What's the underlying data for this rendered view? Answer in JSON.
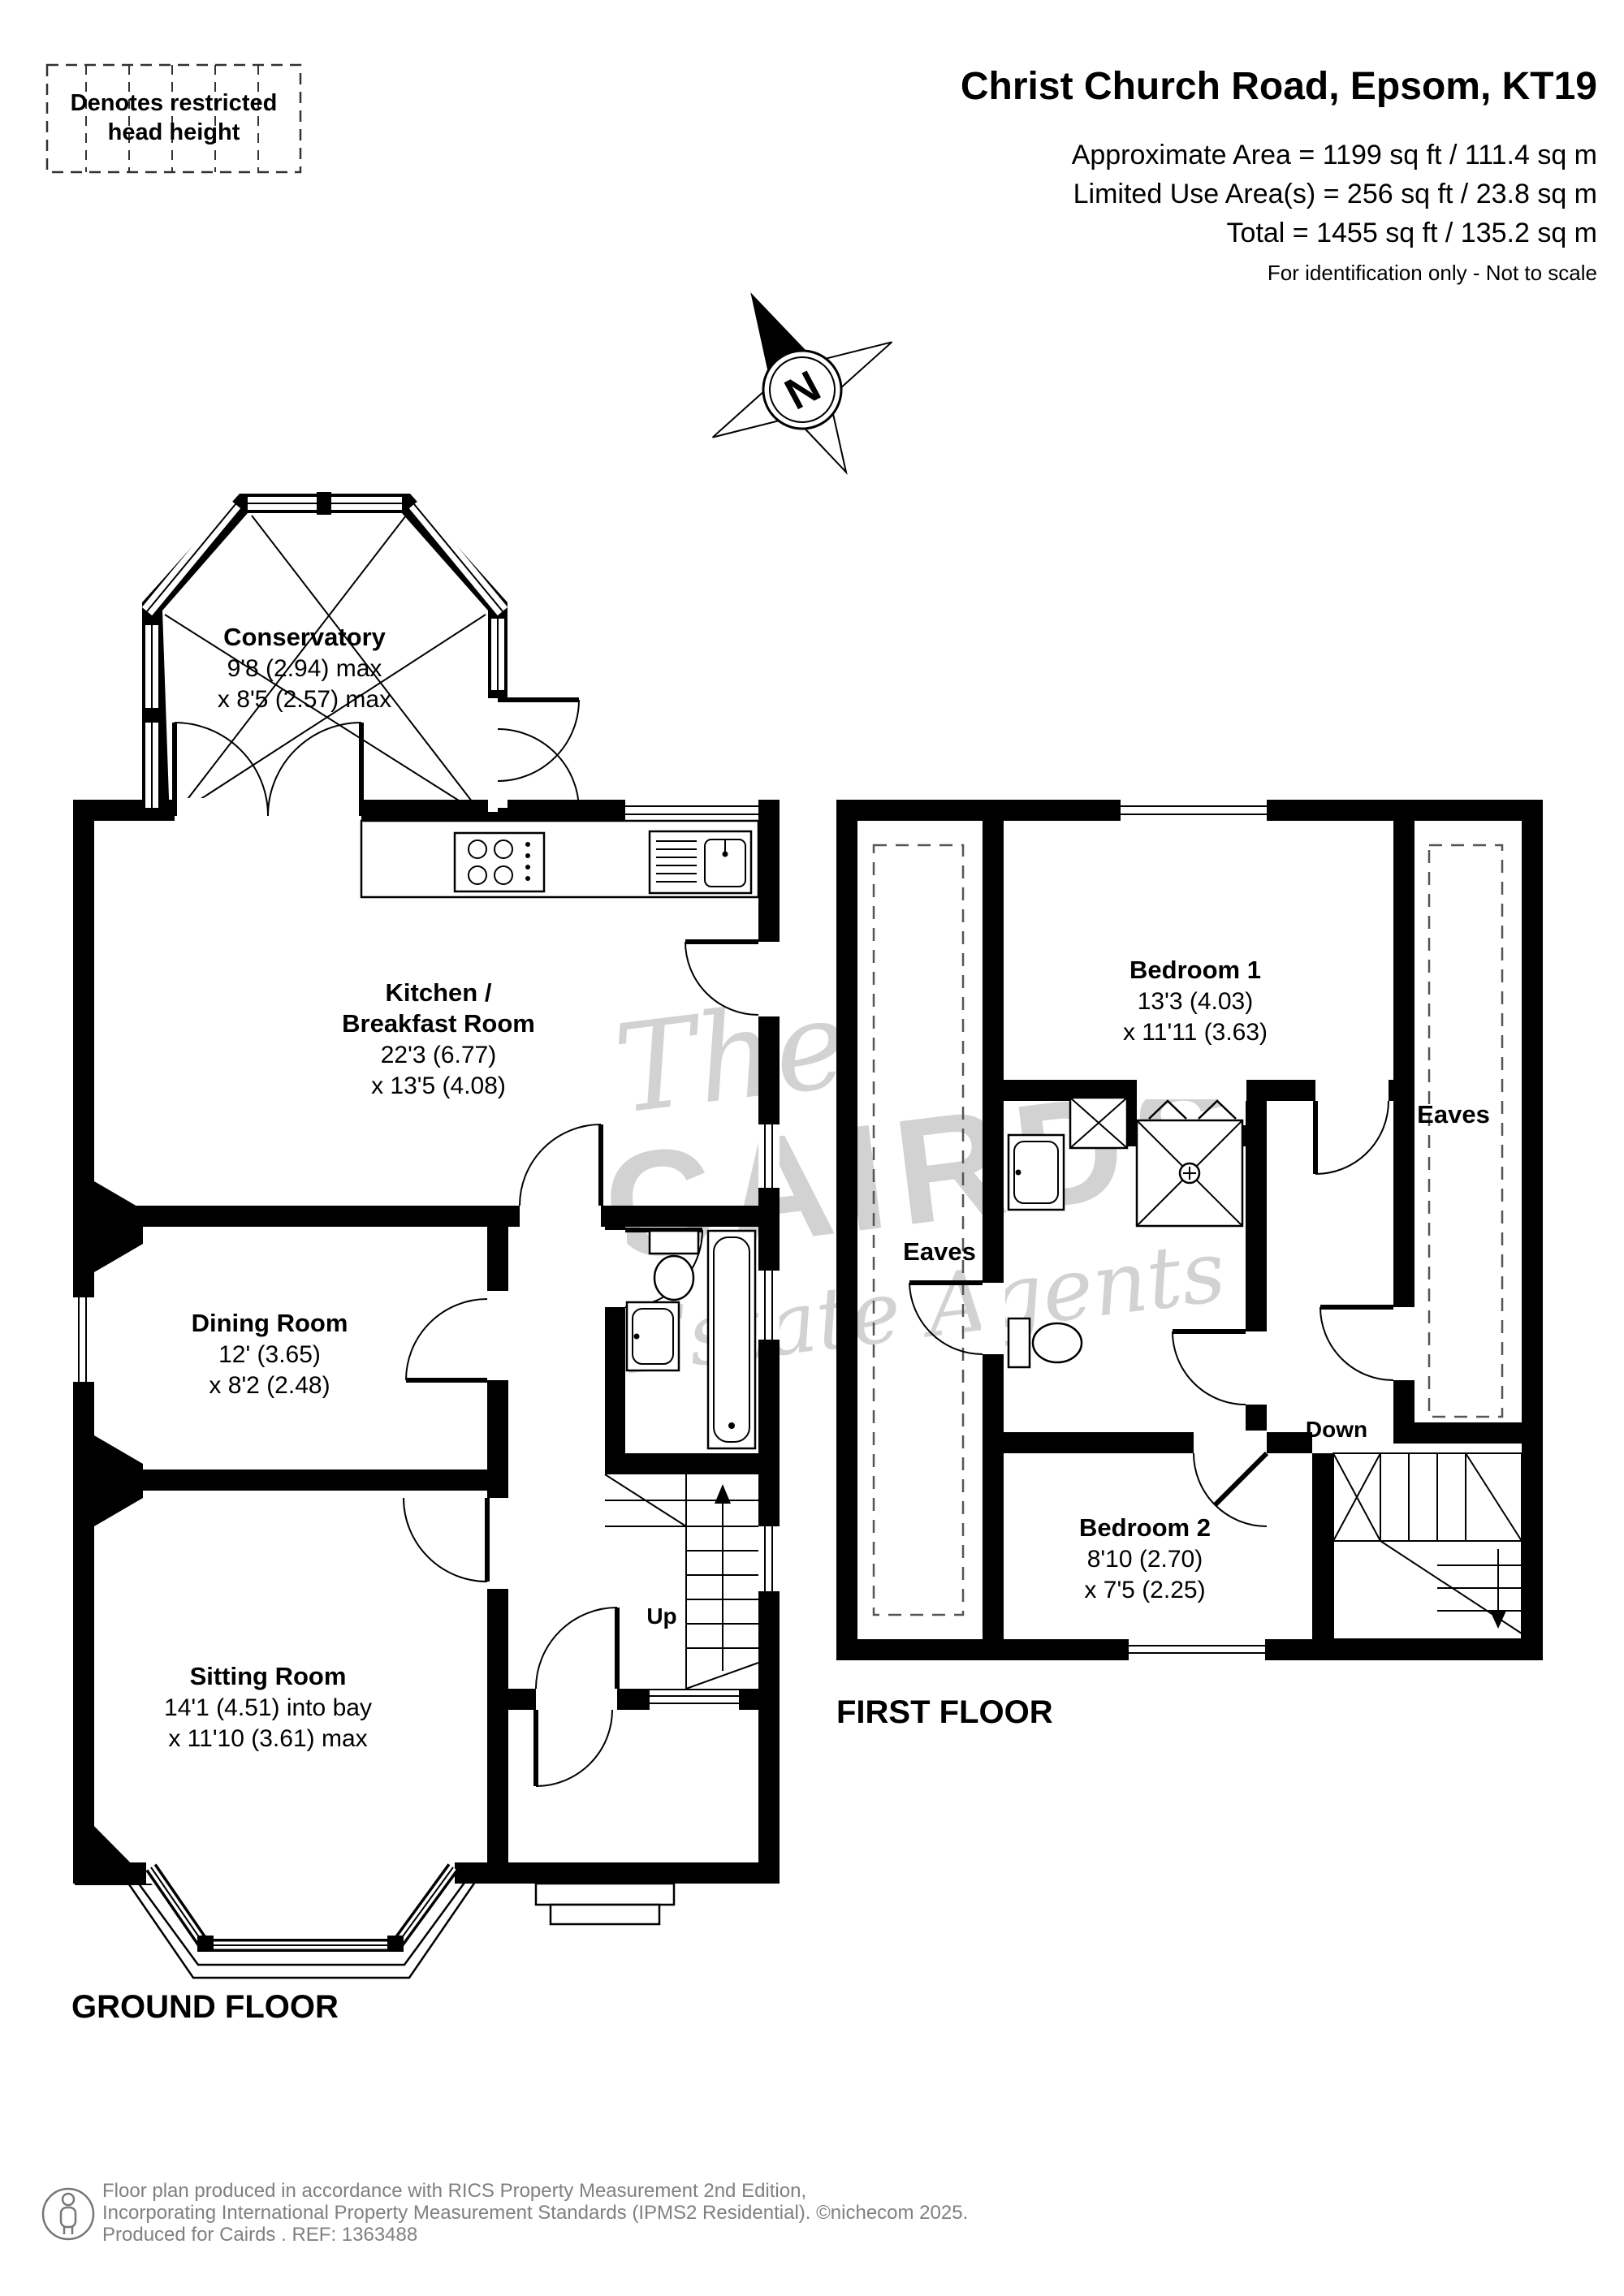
{
  "header": {
    "legend": {
      "line1": "Denotes restricted",
      "line2": "head height"
    },
    "title": "Christ Church Road, Epsom, KT19",
    "area_line1": "Approximate Area = 1199 sq ft / 111.4 sq m",
    "area_line2": "Limited Use Area(s) = 256 sq ft / 23.8 sq m",
    "area_line3": "Total = 1455 sq ft / 135.2 sq m",
    "disclaimer": "For identification only - Not to scale"
  },
  "compass": {
    "label": "N"
  },
  "ground_floor": {
    "floor_label": "GROUND FLOOR",
    "stairs_label": "Up",
    "rooms": {
      "conservatory": {
        "name": "Conservatory",
        "dim1": "9'8 (2.94) max",
        "dim2": "x 8'5 (2.57) max"
      },
      "kitchen": {
        "name1": "Kitchen /",
        "name2": "Breakfast Room",
        "dim1": "22'3 (6.77)",
        "dim2": "x 13'5 (4.08)"
      },
      "dining": {
        "name": "Dining Room",
        "dim1": "12' (3.65)",
        "dim2": "x 8'2 (2.48)"
      },
      "sitting": {
        "name": "Sitting Room",
        "dim1": "14'1 (4.51) into bay",
        "dim2": "x 11'10 (3.61) max"
      }
    }
  },
  "first_floor": {
    "floor_label": "FIRST FLOOR",
    "stairs_label": "Down",
    "rooms": {
      "bedroom1": {
        "name": "Bedroom 1",
        "dim1": "13'3 (4.03)",
        "dim2": "x 11'11 (3.63)"
      },
      "bedroom2": {
        "name": "Bedroom 2",
        "dim1": "8'10 (2.70)",
        "dim2": "x 7'5 (2.25)"
      },
      "eaves_left": "Eaves",
      "eaves_right": "Eaves"
    }
  },
  "watermark": {
    "line1": "The",
    "line2": "CAIRDS",
    "line3": "Estate Agents"
  },
  "footer": {
    "line1": "Floor plan produced in accordance with RICS Property Measurement 2nd Edition,",
    "line2": "Incorporating International Property Measurement Standards (IPMS2 Residential).   ©nichecom 2025.",
    "line3": "Produced for Cairds .   REF:  1363488"
  }
}
